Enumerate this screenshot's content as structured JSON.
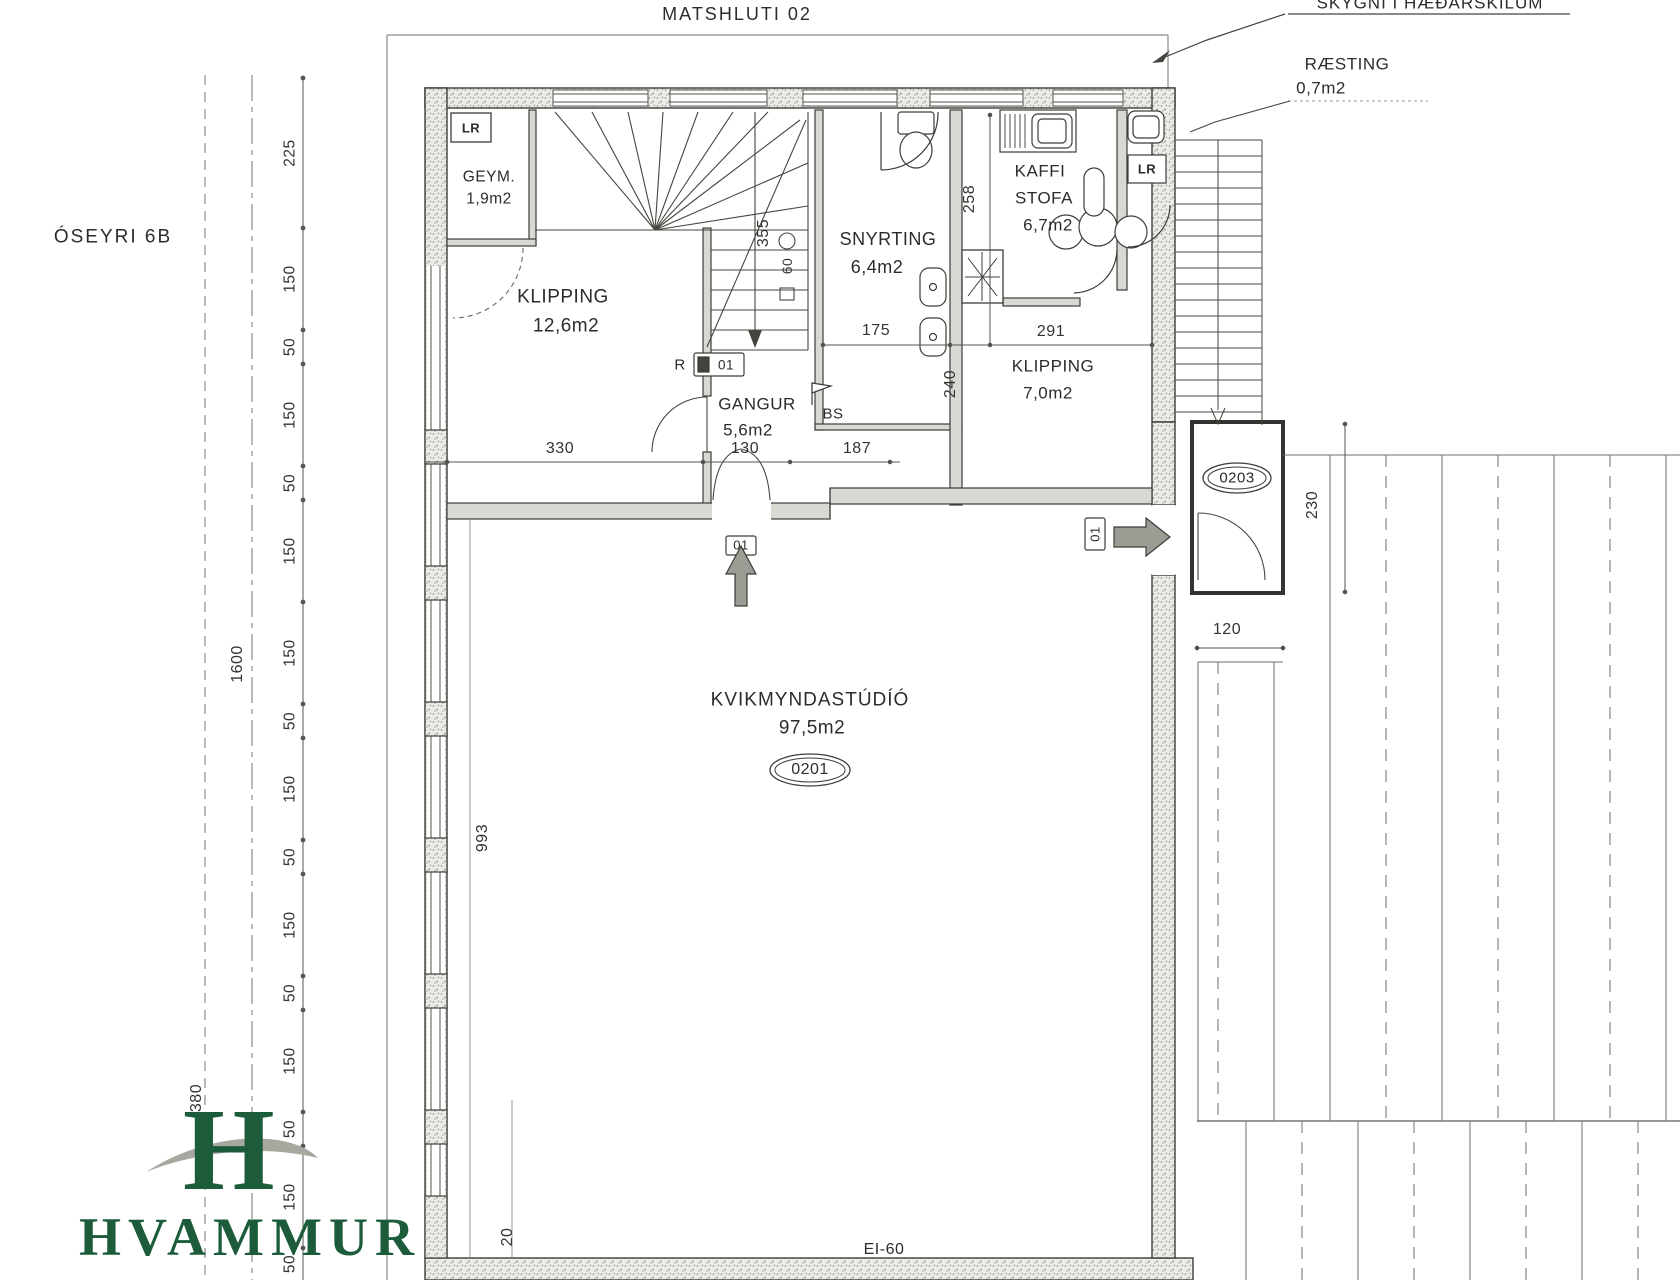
{
  "page": {
    "title": "MATSHLUTI 02",
    "street": "ÓSEYRI 6B",
    "skylight_note": "SKYGNI Í HÆÐARSKILUM",
    "fire_rating": "EI-60"
  },
  "rooms": {
    "geym": {
      "name": "GEYM.",
      "area": "1,9m2"
    },
    "klipping_large": {
      "name": "KLIPPING",
      "area": "12,6m2"
    },
    "snyrting": {
      "name": "SNYRTING",
      "area": "6,4m2"
    },
    "kaffistofa": {
      "name1": "KAFFI",
      "name2": "STOFA",
      "area": "6,7m2"
    },
    "klipping_small": {
      "name": "KLIPPING",
      "area": "7,0m2"
    },
    "gangur": {
      "name": "GANGUR",
      "area": "5,6m2"
    },
    "raesting": {
      "name": "RÆSTING",
      "area": "0,7m2"
    },
    "studio": {
      "name": "KVIKMYNDASTÚDÍÓ",
      "area": "97,5m2",
      "tag": "0201"
    }
  },
  "tags": {
    "vestibule": "0203",
    "main_door": "01",
    "side_door": "01",
    "stair_door": "01",
    "stair_r": "R",
    "bs": "BS",
    "lr": "LR"
  },
  "dims": {
    "left_chain": [
      "225",
      "150",
      "50",
      "150",
      "50",
      "150",
      "150",
      "50",
      "150",
      "50",
      "150",
      "50",
      "150",
      "50",
      "150",
      "50"
    ],
    "lot_width": "1600",
    "lot_offset": "380",
    "studio_left": "993",
    "wall": "20",
    "klipping_width": "330",
    "gangur_width": "130",
    "gangur_right": "187",
    "snyrting_depth": "355",
    "snyrting_door": "175",
    "klipping_small_width": "291",
    "kaffi_depth": "258",
    "klipping_small_depth": "240",
    "stair_width": "60",
    "vestibule_depth": "230",
    "vestibule_width": "120"
  },
  "logo": {
    "monogram": "H",
    "name": "HVAMMUR"
  }
}
